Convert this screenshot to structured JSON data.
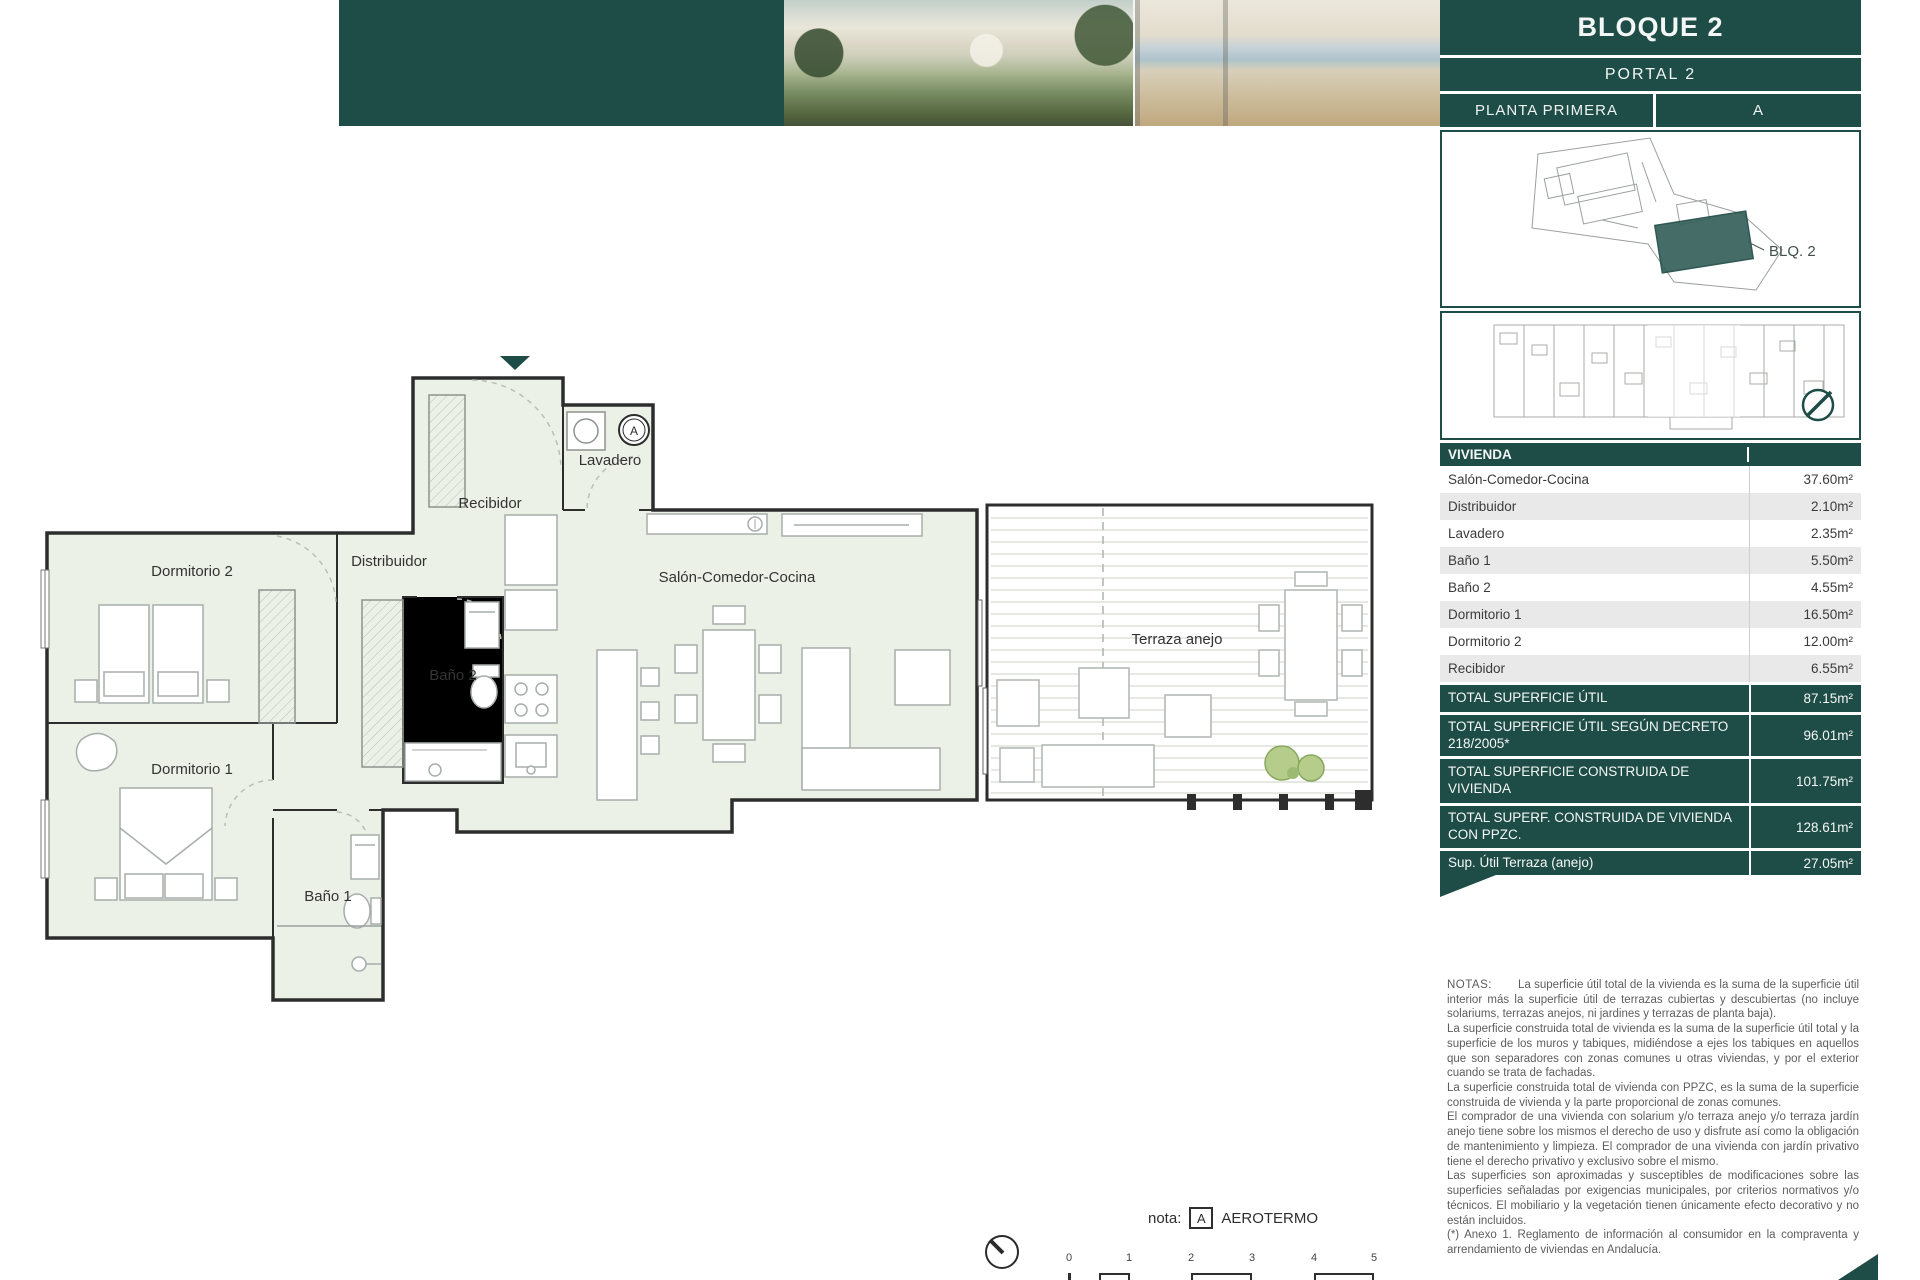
{
  "header": {
    "title": "BLOQUE 2",
    "portal": "PORTAL 2",
    "planta": "PLANTA PRIMERA",
    "unit": "A"
  },
  "siteplan": {
    "block_label": "BLQ. 2"
  },
  "floorplan": {
    "recibidor": "Recibidor",
    "lavadero": "Lavadero",
    "dormitorio2": "Dormitorio 2",
    "distribuidor": "Distribuidor",
    "bano2": "Baño 2",
    "salon": "Salón-Comedor-Cocina",
    "terraza": "Terraza anejo",
    "dormitorio1": "Dormitorio 1",
    "bano1": "Baño 1",
    "aerotermo_symbol": "A"
  },
  "table": {
    "header": "VIVIENDA",
    "rows": [
      {
        "label": "Salón-Comedor-Cocina",
        "value": "37.60m²"
      },
      {
        "label": "Distribuidor",
        "value": "2.10m²"
      },
      {
        "label": "Lavadero",
        "value": "2.35m²"
      },
      {
        "label": "Baño 1",
        "value": "5.50m²"
      },
      {
        "label": "Baño 2",
        "value": "4.55m²"
      },
      {
        "label": "Dormitorio 1",
        "value": "16.50m²"
      },
      {
        "label": "Dormitorio 2",
        "value": "12.00m²"
      },
      {
        "label": "Recibidor",
        "value": "6.55m²"
      }
    ],
    "totals": [
      {
        "label": "TOTAL SUPERFICIE ÚTIL",
        "value": "87.15m²"
      },
      {
        "label": "TOTAL SUPERFICIE ÚTIL SEGÚN DECRETO 218/2005*",
        "value": "96.01m²"
      },
      {
        "label": "TOTAL SUPERFICIE CONSTRUIDA DE VIVIENDA",
        "value": "101.75m²"
      },
      {
        "label": "TOTAL SUPERF. CONSTRUIDA DE VIVIENDA CON PPZC.",
        "value": "128.61m²"
      },
      {
        "label": "Sup. Útil Terraza (anejo)",
        "value": "27.05m²"
      }
    ]
  },
  "notes": {
    "heading": "NOTAS:",
    "p1": "La superficie útil total de la vivienda es la suma de la superficie útil interior más la superficie útil de terrazas cubiertas y descubiertas (no incluye solariums, terrazas anejos, ni jardines y terrazas de planta baja).",
    "p2": "La superficie construida total de vivienda es la suma de la superficie útil total y la superficie de los muros y tabiques, midiéndose a ejes los tabiques en aquellos que son separadores con zonas comunes u otras viviendas, y por el exterior cuando se trata de fachadas.",
    "p3": "La superficie construida total de vivienda con PPZC, es la suma de la superficie construida de vivienda y la parte proporcional de zonas comunes.",
    "p4": "El comprador de una vivienda con solarium y/o terraza anejo y/o terraza jardín anejo tiene sobre los mismos el derecho de uso y disfrute así como la obligación de mantenimiento y limpieza. El comprador de una vivienda con jardín privativo tiene el derecho privativo y exclusivo sobre el mismo.",
    "p5": "Las superficies son aproximadas y susceptibles de modificaciones sobre las superficies señaladas por exigencias municipales, por criterios normativos y/o técnicos. El mobiliario y la vegetación tienen únicamente efecto decorativo y no están incluidos.",
    "p6": "(*) Anexo 1. Reglamento de información al consumidor en la compraventa y arrendamiento de viviendas en Andalucía."
  },
  "footer": {
    "nota_label": "nota:",
    "aerotermo_symbol": "A",
    "aerotermo_text": "AEROTERMO",
    "scale_ticks": [
      "0",
      "1",
      "2",
      "3",
      "4",
      "5"
    ]
  },
  "colors": {
    "teal": "#1e4c46",
    "row_alt": "#e9e9e9",
    "room_fill": "#ecf1e8",
    "wall": "#2d2d2d"
  }
}
